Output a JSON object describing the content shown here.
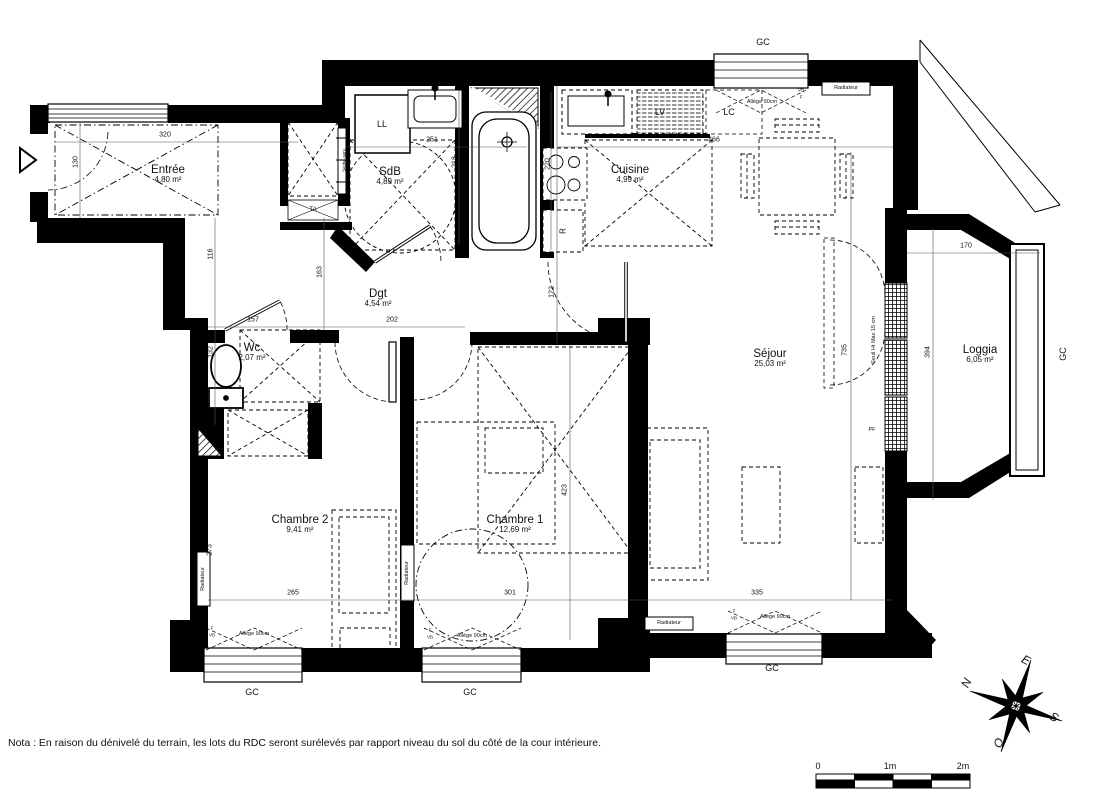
{
  "note": "Nota : En raison du dénivelé du terrain, les lots du RDC seront surélevés par rapport niveau du sol du côté de la cour intérieure.",
  "rooms": {
    "entree": {
      "name": "Entrée",
      "area": "4,80 m²"
    },
    "sdb": {
      "name": "SdB",
      "area": "4,89 m²"
    },
    "cuisine": {
      "name": "Cuisine",
      "area": "4,99 m²"
    },
    "dgt": {
      "name": "Dgt",
      "area": "4,54 m²"
    },
    "wc": {
      "name": "Wc",
      "area": "2,07 m²"
    },
    "chambre2": {
      "name": "Chambre 2",
      "area": "9,41 m²"
    },
    "chambre1": {
      "name": "Chambre 1",
      "area": "12,69 m²"
    },
    "sejour": {
      "name": "Séjour",
      "area": "25,03 m²"
    },
    "loggia": {
      "name": "Loggia",
      "area": "6,05 m²"
    }
  },
  "fixtures": {
    "ll": "LL",
    "lv": "LV",
    "lc": "LC",
    "fridge": "R",
    "ta": "TA"
  },
  "annotations": {
    "gc": "GC",
    "radiator": "Radiateur",
    "sill": "Allège 90cm",
    "threshold": "Seuil Ht Max 15 cm",
    "pf": "PF",
    "f": "F",
    "vb": "VB",
    "towel_dryer": "Sèche-serv."
  },
  "dimensions": {
    "entree_w": "320",
    "entree_d": "130",
    "hall_a": "116",
    "hall_b": "163",
    "wc_w": "157",
    "hall_w": "202",
    "wc_d": "132",
    "sdb_w": "251",
    "sdb_d": "218",
    "kitchen_d": "220",
    "kitchen_pass": "122",
    "sejour_w": "466",
    "sejour_d": "735",
    "sejour_b": "335",
    "loggia_w": "170",
    "loggia_d": "394",
    "ch1_w": "301",
    "ch1_d": "423",
    "ch2_w": "265",
    "ch2_d": "273"
  },
  "compass": {
    "n": "N",
    "e": "E",
    "s": "S",
    "o": "O"
  },
  "scale_bar": {
    "zero": "0",
    "one": "1m",
    "two": "2m"
  },
  "colors": {
    "wall": "#000000",
    "background": "#ffffff",
    "text": "#1a1a1a"
  }
}
